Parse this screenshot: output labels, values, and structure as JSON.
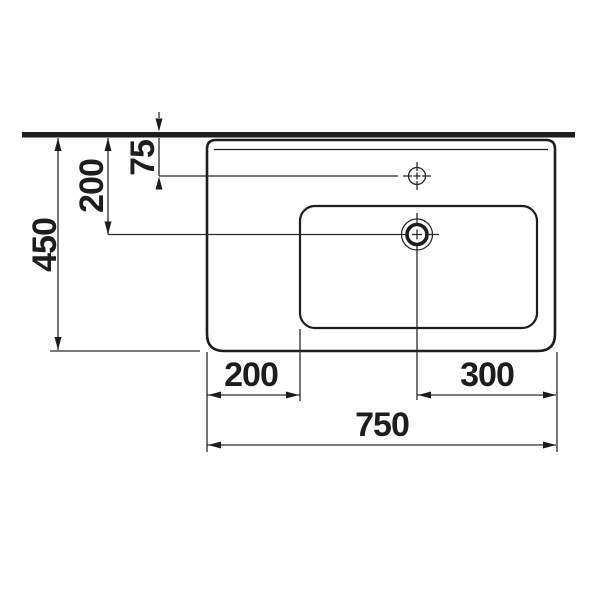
{
  "drawing": {
    "title": "Washbasin technical drawing - top view",
    "unit": "mm",
    "colors": {
      "line": "#1d1d1b",
      "dimension_line": "#2b2b2b",
      "background": "#ffffff"
    },
    "dimensions": {
      "total_depth": "450",
      "wall_to_drain_center": "200",
      "wall_to_tap_center": "75",
      "left_edge_to_bowl": "200",
      "drain_center_to_right_edge": "300",
      "total_width": "750"
    }
  }
}
